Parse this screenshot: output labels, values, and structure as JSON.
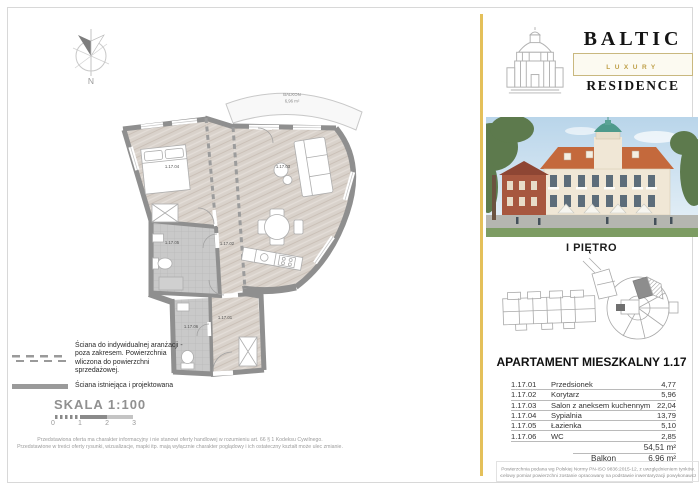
{
  "logo": {
    "brand": "BALTIC",
    "tier": "LUXURY",
    "type": "RESIDENCE"
  },
  "floor": {
    "title": "I PIĘTRO"
  },
  "apartment": {
    "title": "APARTAMENT MIESZKALNY 1.17",
    "rooms": [
      {
        "code": "1.17.01",
        "name": "Przedsionek",
        "area": "4,77"
      },
      {
        "code": "1.17.02",
        "name": "Korytarz",
        "area": "5,96"
      },
      {
        "code": "1.17.03",
        "name": "Salon z aneksem kuchennym",
        "area": "22,04"
      },
      {
        "code": "1.17.04",
        "name": "Sypialnia",
        "area": "13,79"
      },
      {
        "code": "1.17.05",
        "name": "Łazienka",
        "area": "5,10"
      },
      {
        "code": "1.17.06",
        "name": "WC",
        "area": "2,85"
      }
    ],
    "total_area": "54,51 m²",
    "balcony_label": "Balkon",
    "balcony_area": "6,96 m²"
  },
  "plan": {
    "balcony_name": "BALKON",
    "balcony_area": "6,96 m²",
    "labels": {
      "r01": "1.17.01",
      "r02": "1.17.02",
      "r03": "1.17.03",
      "r04": "1.17.04",
      "r05": "1.17.05",
      "r06": "1.17.06"
    },
    "compass_north": "N"
  },
  "legend": {
    "dashed_wall": "Ściana do indywidualnej aranżacji - poza zakresem. Powierzchnia wliczona do powierzchni sprzedażowej.",
    "solid_wall": "Ściana istniejąca i projektowana",
    "scale_title": "SKALA 1:100",
    "scale_ticks": [
      "0",
      "1",
      "2",
      "3"
    ]
  },
  "footnotes": {
    "offer_line1": "Przedstawiona oferta ma charakter informacyjny i nie stanowi oferty handlowej w rozumieniu art. 66 § 1 Kodeksu Cywilnego.",
    "offer_line2": "Przedstawione w treści oferty rysunki, wizualizacje, mapki itp. mają wyłącznie charakter poglądowy i ich ostateczny kształt może ulec zmianie.",
    "area_line1": "Powierzchnia podana wg Polskiej Normy PN-ISO 9836:2015-12, z uwzględnieniem tynków.",
    "area_line2": "Docelowy pomiar powierzchni zostanie opracowany na podstawie inwentaryzacji powykonawczej."
  },
  "colors": {
    "accent_gold": "#e4c05a",
    "wall_gray": "#8f8f8f",
    "wood_floor": "#d9d2cb",
    "tile_floor": "#c9c9c9",
    "luxury_gold": "#bfa04a"
  }
}
